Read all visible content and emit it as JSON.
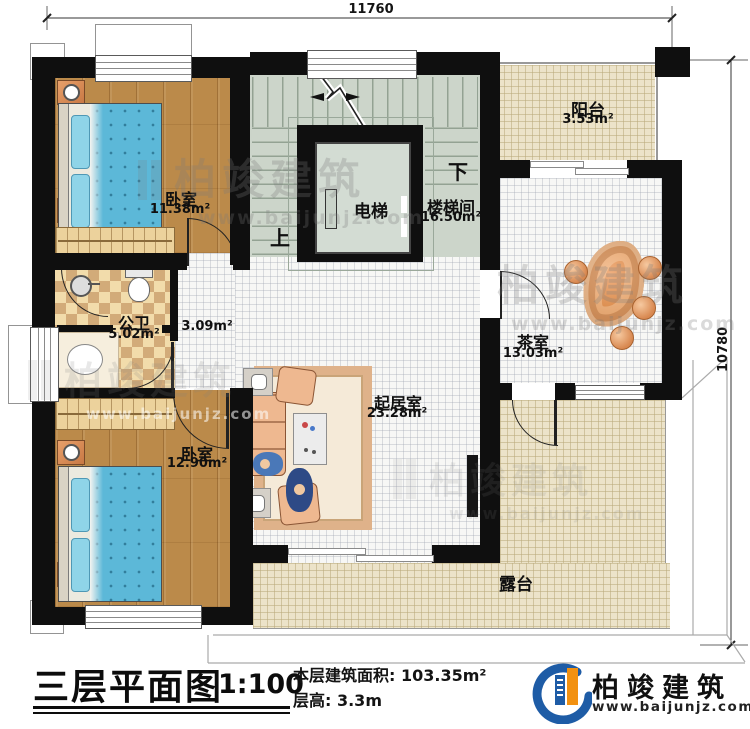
{
  "dims": {
    "top": "11760",
    "right": "10780"
  },
  "rooms": {
    "bedroom1": {
      "name": "卧室",
      "area": "11.38m²"
    },
    "stairwell": {
      "name": "楼梯间",
      "area": "16.50m²"
    },
    "elevator": {
      "name": "电梯"
    },
    "balcony": {
      "name": "阳台",
      "area": "3.53m²"
    },
    "bathroom": {
      "name": "公卫",
      "area": "5.02m²"
    },
    "hallway": {
      "area": "3.09m²"
    },
    "tearoom": {
      "name": "茶室",
      "area": "13.03m²"
    },
    "living": {
      "name": "起居室",
      "area": "23.28m²"
    },
    "bedroom2": {
      "name": "卧室",
      "area": "12.90m²"
    },
    "terrace": {
      "name": "露台"
    }
  },
  "stairs": {
    "up": "上",
    "down": "下"
  },
  "titleblock": {
    "title": "三层平面图",
    "scale": "1:100",
    "area_line": "本层建筑面积: 103.35m²",
    "floor_height_line": "层高: 3.3m"
  },
  "logo": {
    "company": "柏竣建筑",
    "website": "www.baijunjz.com"
  },
  "watermark": {
    "company": "柏竣建筑",
    "website": "www.baijunjz.com"
  },
  "colors": {
    "wall": "#0f0f0f",
    "wood_floor": "#bb8a4a",
    "tile_white": "#f7f7f5",
    "tile_beige": "#ece3c9",
    "stair_floor": "#ccd5ca",
    "checker_light": "#f2dcab",
    "checker_dark": "#d2ab79",
    "bed_blue": "#5cb8d8",
    "sofa_peach": "#eeb890",
    "table_orange": "#d98a4a",
    "logo_blue": "#1e5ca6",
    "logo_orange": "#f29111"
  }
}
